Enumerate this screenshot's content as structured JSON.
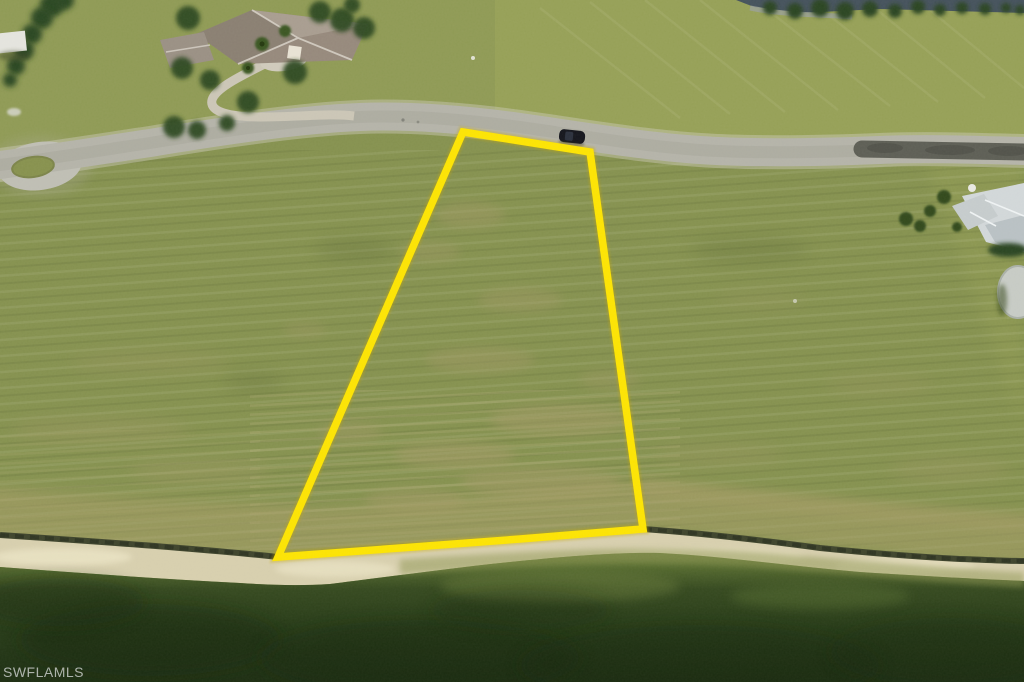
{
  "watermark": {
    "text": "SWFLAMLS"
  },
  "scene": {
    "kind": "aerial-drone-photo-of-vacant-waterfront-lot",
    "objects": [
      "yellow-parcel-outline",
      "residential-road",
      "cul-de-sac-loop",
      "repaved-road-section",
      "black-car",
      "tile-roof-house-with-circular-driveway",
      "white-roof-house",
      "backyard-pond",
      "tree-hedge",
      "upper-lake",
      "shoreline-rock-line",
      "sand-beach",
      "lake-water",
      "grass-field",
      "mowing-stripes",
      "dirt-patches"
    ]
  },
  "colors": {
    "parcel_outline": "#FCE303",
    "parcel_outline_glow": "#C7A900",
    "grass": "#85914F",
    "upper_field": "#97A158",
    "road": "#B4B3A9",
    "road_shoulder": "#CCC9B8",
    "repave_dark": "#5D5E55",
    "sand": "#D7CFAE",
    "rock_line": "#3E442C",
    "dried_band": "#A79D68",
    "water_shallow": "#7B8746",
    "water_deep": "#1D2E12",
    "upper_lake": "#45525C",
    "car": "#15161D",
    "tree": "#2D4A22",
    "roof_left_house": "#96897C",
    "roof_right_house": "#D2D7D9",
    "pond": "#C7CBC5",
    "watermark_text": "#C6CAC6"
  }
}
